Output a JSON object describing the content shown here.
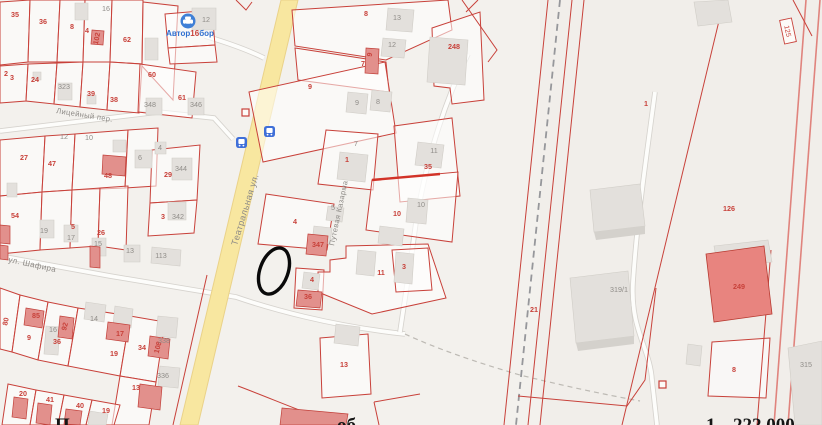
{
  "map": {
    "poi": {
      "icon": "car-poi-icon",
      "name_parts": {
        "left": "Автор",
        "mid": "16",
        "right": "бор"
      }
    },
    "streets": [
      {
        "name": "Театральная ул.",
        "x": 237,
        "y": 246,
        "rot": -73,
        "fs": 9
      },
      {
        "name": "ул. Шафира",
        "x": 8,
        "y": 262,
        "rot": 12,
        "fs": 8
      },
      {
        "name": "Лицейный пер.",
        "x": 56,
        "y": 113,
        "rot": 9,
        "fs": 7.5
      },
      {
        "name": "Путевая Казарма",
        "x": 334,
        "y": 246,
        "rot": -78,
        "fs": 7.5
      }
    ],
    "boxed_label": {
      "t": "125"
    },
    "parcel_numbers": [
      {
        "t": "35",
        "x": 15,
        "y": 17
      },
      {
        "t": "36",
        "x": 43,
        "y": 24
      },
      {
        "t": "8",
        "x": 72,
        "y": 29
      },
      {
        "t": "4",
        "x": 87,
        "y": 33
      },
      {
        "t": "62",
        "x": 127,
        "y": 42
      },
      {
        "t": "2",
        "x": 6,
        "y": 76
      },
      {
        "t": "3",
        "x": 12,
        "y": 80
      },
      {
        "t": "24",
        "x": 35,
        "y": 82
      },
      {
        "t": "39",
        "x": 91,
        "y": 96
      },
      {
        "t": "38",
        "x": 114,
        "y": 102
      },
      {
        "t": "60",
        "x": 152,
        "y": 77
      },
      {
        "t": "61",
        "x": 182,
        "y": 100
      },
      {
        "t": "102",
        "x": 99,
        "y": 39,
        "rot": -78
      },
      {
        "t": "27",
        "x": 24,
        "y": 160
      },
      {
        "t": "47",
        "x": 52,
        "y": 166
      },
      {
        "t": "48",
        "x": 108,
        "y": 178
      },
      {
        "t": "29",
        "x": 168,
        "y": 177
      },
      {
        "t": "3",
        "x": 163,
        "y": 219
      },
      {
        "t": "54",
        "x": 15,
        "y": 218
      },
      {
        "t": "5",
        "x": 73,
        "y": 229
      },
      {
        "t": "26",
        "x": 101,
        "y": 235
      },
      {
        "t": "80",
        "x": 8,
        "y": 322,
        "rot": -78
      },
      {
        "t": "85",
        "x": 36,
        "y": 318
      },
      {
        "t": "9",
        "x": 29,
        "y": 340
      },
      {
        "t": "36",
        "x": 57,
        "y": 344
      },
      {
        "t": "92",
        "x": 67,
        "y": 327,
        "rot": -75
      },
      {
        "t": "17",
        "x": 120,
        "y": 336
      },
      {
        "t": "19",
        "x": 114,
        "y": 356
      },
      {
        "t": "34",
        "x": 142,
        "y": 350
      },
      {
        "t": "108",
        "x": 160,
        "y": 348,
        "rot": -75
      },
      {
        "t": "13",
        "x": 136,
        "y": 390
      },
      {
        "t": "20",
        "x": 23,
        "y": 396
      },
      {
        "t": "41",
        "x": 50,
        "y": 402
      },
      {
        "t": "40",
        "x": 80,
        "y": 408
      },
      {
        "t": "19",
        "x": 106,
        "y": 413
      },
      {
        "t": "8",
        "x": 366,
        "y": 16
      },
      {
        "t": "7",
        "x": 363,
        "y": 66
      },
      {
        "t": "9",
        "x": 310,
        "y": 89
      },
      {
        "t": "9",
        "x": 372,
        "y": 55,
        "rot": -80
      },
      {
        "t": "248",
        "x": 454,
        "y": 49
      },
      {
        "t": "1",
        "x": 347,
        "y": 162
      },
      {
        "t": "35",
        "x": 428,
        "y": 169
      },
      {
        "t": "10",
        "x": 397,
        "y": 216
      },
      {
        "t": "4",
        "x": 295,
        "y": 224
      },
      {
        "t": "4",
        "x": 312,
        "y": 282
      },
      {
        "t": "347",
        "x": 318,
        "y": 247
      },
      {
        "t": "36",
        "x": 308,
        "y": 299
      },
      {
        "t": "11",
        "x": 381,
        "y": 275
      },
      {
        "t": "3",
        "x": 404,
        "y": 269
      },
      {
        "t": "13",
        "x": 344,
        "y": 367
      },
      {
        "t": "1",
        "x": 646,
        "y": 106
      },
      {
        "t": "126",
        "x": 729,
        "y": 211
      },
      {
        "t": "21",
        "x": 534,
        "y": 312
      },
      {
        "t": "249",
        "x": 739,
        "y": 289
      },
      {
        "t": "8",
        "x": 734,
        "y": 372
      }
    ],
    "building_numbers": [
      {
        "t": "16",
        "x": 106,
        "y": 11
      },
      {
        "t": "12",
        "x": 206,
        "y": 22
      },
      {
        "t": "323",
        "x": 64,
        "y": 89
      },
      {
        "t": "348",
        "x": 150,
        "y": 107
      },
      {
        "t": "346",
        "x": 196,
        "y": 107
      },
      {
        "t": "10",
        "x": 89,
        "y": 140
      },
      {
        "t": "12",
        "x": 64,
        "y": 139
      },
      {
        "t": "4",
        "x": 160,
        "y": 150
      },
      {
        "t": "6",
        "x": 140,
        "y": 160
      },
      {
        "t": "344",
        "x": 181,
        "y": 171
      },
      {
        "t": "342",
        "x": 178,
        "y": 219
      },
      {
        "t": "19",
        "x": 44,
        "y": 233
      },
      {
        "t": "17",
        "x": 71,
        "y": 240
      },
      {
        "t": "15",
        "x": 98,
        "y": 246
      },
      {
        "t": "13",
        "x": 130,
        "y": 253
      },
      {
        "t": "113",
        "x": 161,
        "y": 258
      },
      {
        "t": "14",
        "x": 94,
        "y": 321
      },
      {
        "t": "16",
        "x": 53,
        "y": 332
      },
      {
        "t": "338",
        "x": 164,
        "y": 343
      },
      {
        "t": "336",
        "x": 163,
        "y": 378
      },
      {
        "t": "13",
        "x": 397,
        "y": 20
      },
      {
        "t": "12",
        "x": 392,
        "y": 47
      },
      {
        "t": "9",
        "x": 357,
        "y": 105
      },
      {
        "t": "8",
        "x": 378,
        "y": 104
      },
      {
        "t": "7",
        "x": 356,
        "y": 146
      },
      {
        "t": "11",
        "x": 434,
        "y": 153
      },
      {
        "t": "10",
        "x": 421,
        "y": 207
      },
      {
        "t": "5",
        "x": 333,
        "y": 210
      },
      {
        "t": "319/1",
        "x": 619,
        "y": 292
      },
      {
        "t": "315",
        "x": 806,
        "y": 367
      }
    ],
    "caption_fragments": [
      {
        "t": "П",
        "x": 55
      },
      {
        "t": "об",
        "x": 337
      },
      {
        "t": "1",
        "x": 706
      },
      {
        "t": "222 000",
        "x": 733
      }
    ],
    "colors": {
      "parcel_red": "#c8413a",
      "label_gray": "#908d89",
      "street_gray": "#8d8a86",
      "poi_blue": "#2f6fd0",
      "road_yellow": "#f8e7a0",
      "annotation_black": "#0a0a0a"
    }
  }
}
